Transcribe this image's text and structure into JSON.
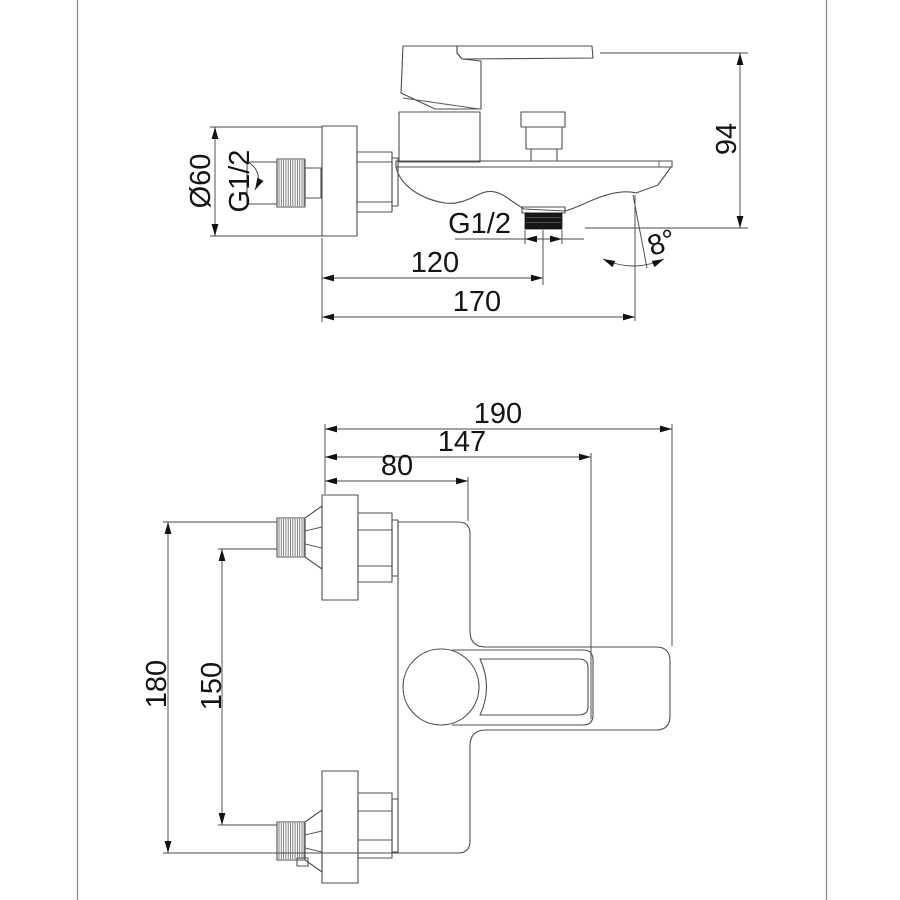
{
  "drawing": {
    "side_view": {
      "escutcheon_diameter": "Ø60",
      "wall_thread": "G1/2",
      "outlet_thread": "G1/2",
      "outlet_offset": "120",
      "overall_length": "170",
      "height": "94",
      "spout_angle": "8°"
    },
    "plan_view": {
      "overall_length": "190",
      "handle_reach": "147",
      "body_depth": "80",
      "overall_span": "180",
      "centers_distance": "150"
    },
    "colors": {
      "line": "#4f4f4f",
      "dimension_line": "#4a4a4a",
      "text": "#141414",
      "outlet_fill": "#171717",
      "background": "#ffffff"
    }
  }
}
